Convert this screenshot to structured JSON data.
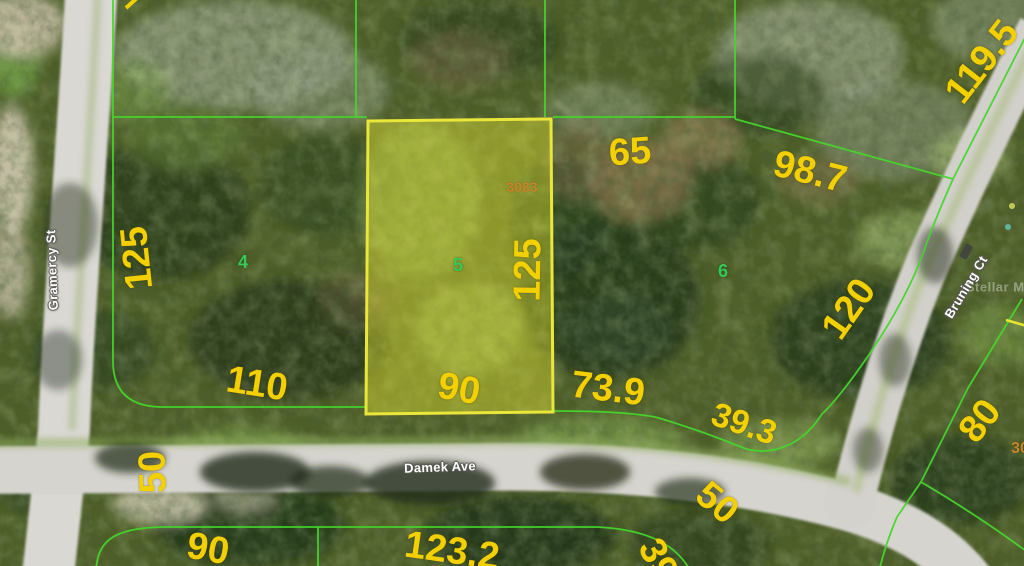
{
  "map": {
    "type": "aerial-parcel-map",
    "watermark": "Stellar MLS",
    "streets": {
      "gramercy": "Gramercy St",
      "damek": "Damek Ave",
      "bruning": "Bruning Ct"
    },
    "highlighted_parcel": {
      "parcel_id": "3083",
      "lot_number": "5",
      "width_label": "90",
      "depth_label": "125"
    },
    "parcel_numbers": {
      "p4": "4",
      "p5": "5",
      "p6": "6"
    },
    "parcel_ids": {
      "id_3083": "3083",
      "id_partial": "30"
    },
    "dimensions": {
      "dim_125_west": "125",
      "dim_125_east": "125",
      "dim_65": "65",
      "dim_98_7": "98.7",
      "dim_119_5": "119.5",
      "dim_110": "110",
      "dim_90_mid": "90",
      "dim_73_9": "73.9",
      "dim_39_3": "39.3",
      "dim_120": "120",
      "dim_50_west": "50",
      "dim_50_east": "50",
      "dim_80": "80",
      "dim_90_south": "90",
      "dim_123_2": "123.2",
      "dim_39_partial": "39"
    },
    "colors": {
      "boundary_green": "#46d62c",
      "highlight_yellow": "#ebe73a",
      "dimension_text": "#f4d000",
      "parcel_number_green": "#35c957",
      "parcel_id_orange": "#c8862b"
    }
  }
}
